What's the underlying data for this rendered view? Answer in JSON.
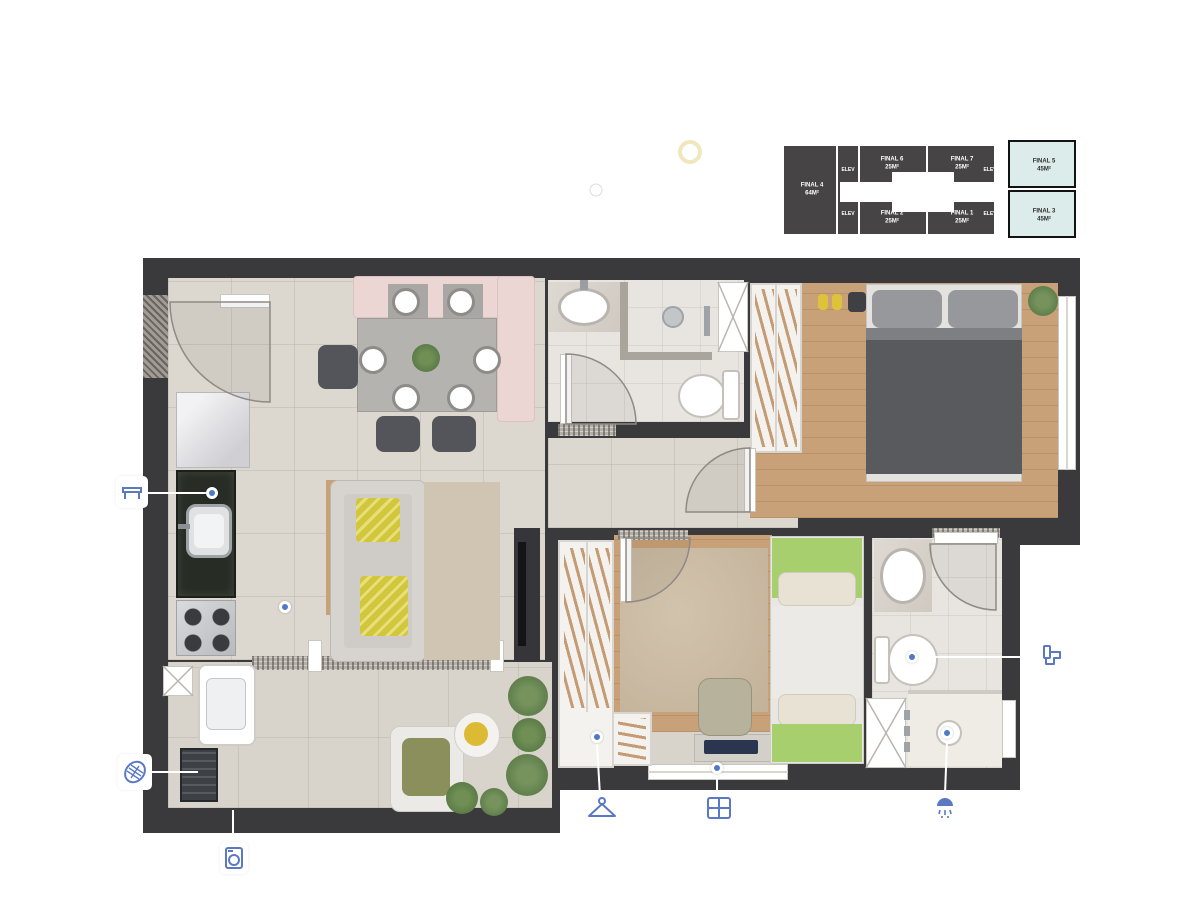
{
  "header": {
    "area_title": "45,87 M²",
    "type_label": "TIPO",
    "sun_label_line1": "SOL DA",
    "sun_label_line2": "MANHÃ"
  },
  "keyplan": {
    "elevator_label": "ELEV",
    "units": [
      {
        "name": "FINAL 4",
        "area": "64M²",
        "highlight": false
      },
      {
        "name": "FINAL 6",
        "area": "25M²",
        "highlight": false
      },
      {
        "name": "FINAL 7",
        "area": "25M²",
        "highlight": false
      },
      {
        "name": "FINAL 2",
        "area": "25M²",
        "highlight": false
      },
      {
        "name": "FINAL 1",
        "area": "25M²",
        "highlight": false
      },
      {
        "name": "FINAL 5",
        "area": "45M²",
        "highlight": true
      },
      {
        "name": "FINAL 3",
        "area": "45M²",
        "highlight": true
      }
    ],
    "highlight_color": "#dcecea",
    "unit_color": "#474445"
  },
  "callouts": {
    "counter": "BANCADA",
    "grill": "CHURRASQUEIRA",
    "laundry": "LAVANDERIA",
    "closet": "CLOSET",
    "window": "JANELA",
    "shower": "DUCHA",
    "toilet": "BANHEIRO"
  },
  "colors": {
    "wall": "#3a3a3c",
    "accent_blue": "#4f79c7",
    "icon_blue": "#5b79c2",
    "keyplan_highlight": "#dcecea",
    "bed_green": "#a8cf6d",
    "pillow_yellow": "#d2c63c",
    "banquette_pink": "#ebd6d4",
    "wood_floor": "#c8a178",
    "granite_counter": "#272c24"
  }
}
